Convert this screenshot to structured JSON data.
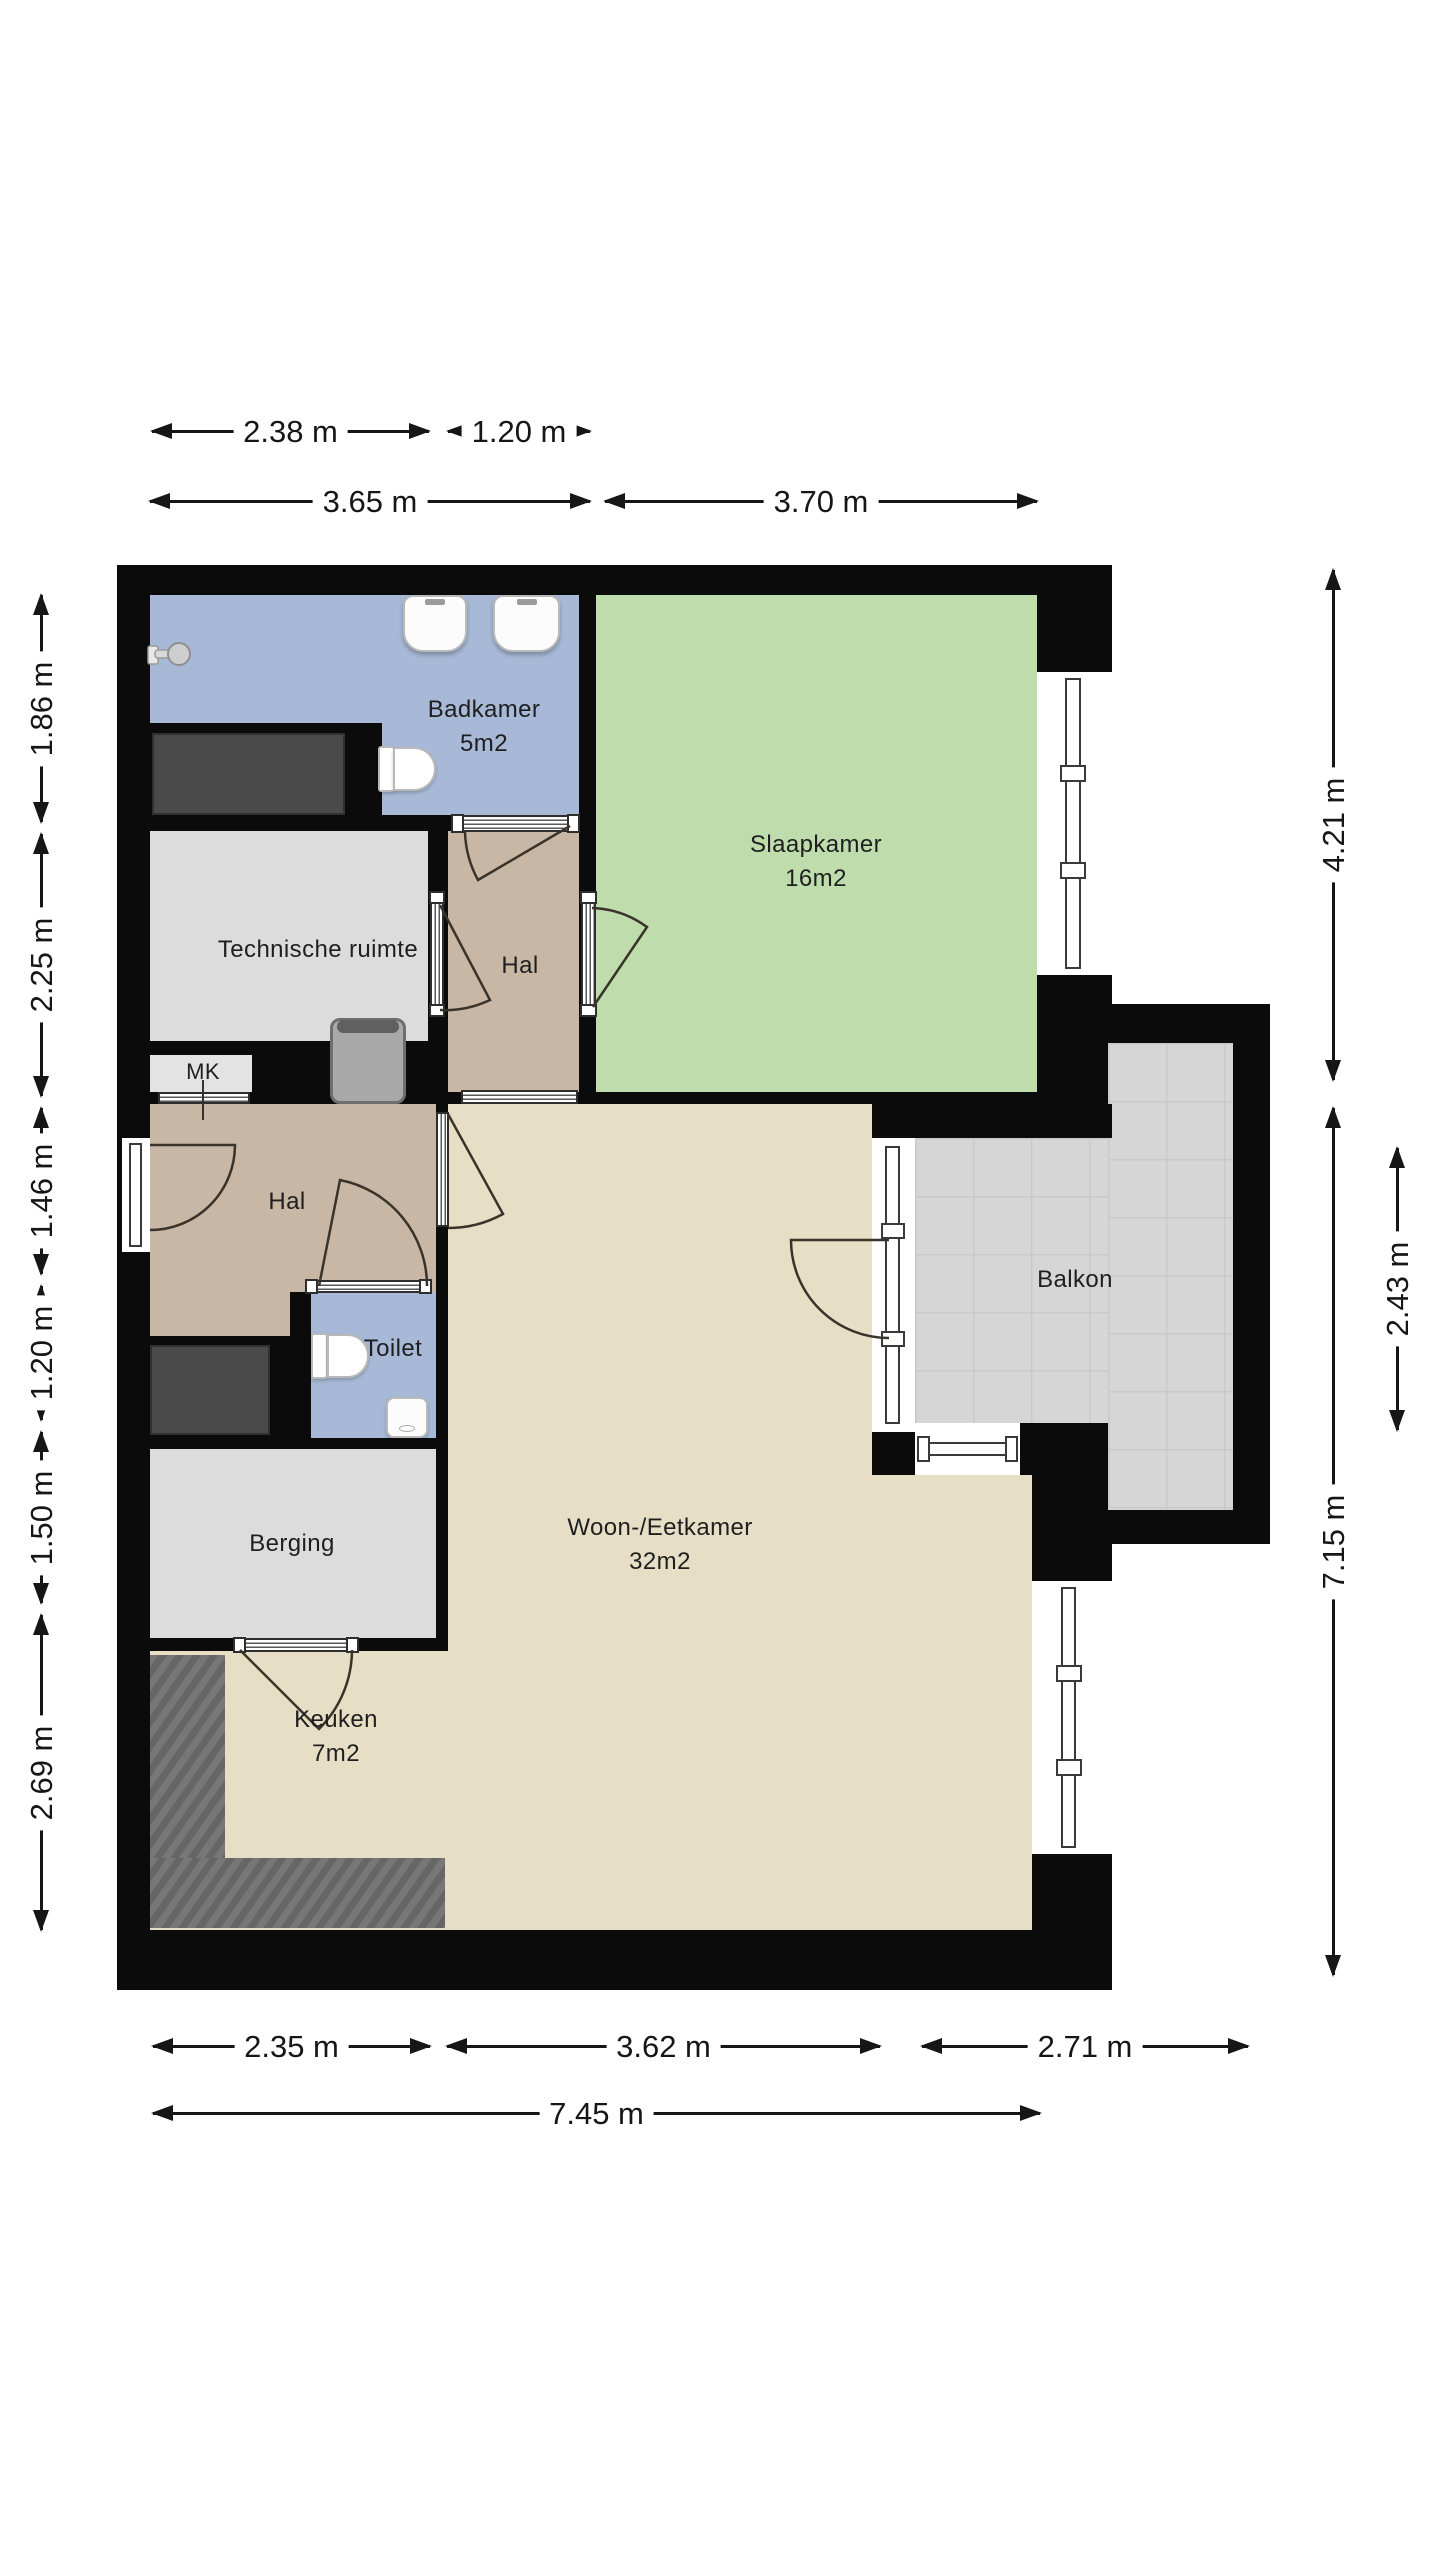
{
  "rooms": {
    "badkamer": {
      "label": "Badkamer",
      "area": "5m2"
    },
    "slaapkamer": {
      "label": "Slaapkamer",
      "area": "16m2"
    },
    "technische_ruimte": {
      "label": "Technische ruimte"
    },
    "hal_boven": {
      "label": "Hal"
    },
    "mk": {
      "label": "MK"
    },
    "hal": {
      "label": "Hal"
    },
    "toilet": {
      "label": "Toilet"
    },
    "berging": {
      "label": "Berging"
    },
    "woon_eetkamer": {
      "label": "Woon-/Eetkamer",
      "area": "32m2"
    },
    "keuken": {
      "label": "Keuken",
      "area": "7m2"
    },
    "balkon": {
      "label": "Balkon"
    }
  },
  "dimensions": {
    "top_row_1": [
      {
        "label": "2.38 m"
      },
      {
        "label": "1.20 m"
      }
    ],
    "top_row_2": [
      {
        "label": "3.65 m"
      },
      {
        "label": "3.70 m"
      }
    ],
    "bottom_row_1": [
      {
        "label": "2.35 m"
      },
      {
        "label": "3.62 m"
      },
      {
        "label": "2.71 m"
      }
    ],
    "bottom_row_2": [
      {
        "label": "7.45 m"
      }
    ],
    "left": [
      {
        "label": "1.86 m"
      },
      {
        "label": "2.25 m"
      },
      {
        "label": "1.46 m"
      },
      {
        "label": "1.20 m"
      },
      {
        "label": "1.50 m"
      },
      {
        "label": "2.69 m"
      }
    ],
    "right": [
      {
        "label": "4.21 m"
      },
      {
        "label": "2.43 m"
      },
      {
        "label": "7.15 m"
      }
    ]
  },
  "icons": {
    "shower-head-icon": "gray circle head with wall arm",
    "sink-icon": "white rounded square with faucet tick",
    "toilet-icon": "white tank plus half-stadium bowl",
    "boiler-icon": "gray rounded square with dark lid",
    "wardrobe-icon": "dark gray rectangle",
    "kitchen-counter-icon": "textured dark gray L strip",
    "window-icon": "white band with thin double glass line",
    "door-sill-icon": "white striped threshold with end caps",
    "door-arc-icon": "quarter circle swing arc"
  },
  "colors": {
    "wall": "#0b0b0b",
    "badkamer_floor": "#a7b9d6",
    "slaapkamer_floor": "#bedcac",
    "hal_floor": "#c8b7a5",
    "utility_floor": "#dcdcdc",
    "living_floor": "#e7dfc5",
    "balkon_floor": "#d6d6d6",
    "balkon_grid": "#c9c9c9",
    "dark_unit": "#4a4a4a",
    "counter": "#6f6f6f",
    "dimension": "#161616",
    "label_text": "#1f1f1f",
    "fixture_border": "#b9b9b9",
    "door_arc": "#39332b"
  }
}
